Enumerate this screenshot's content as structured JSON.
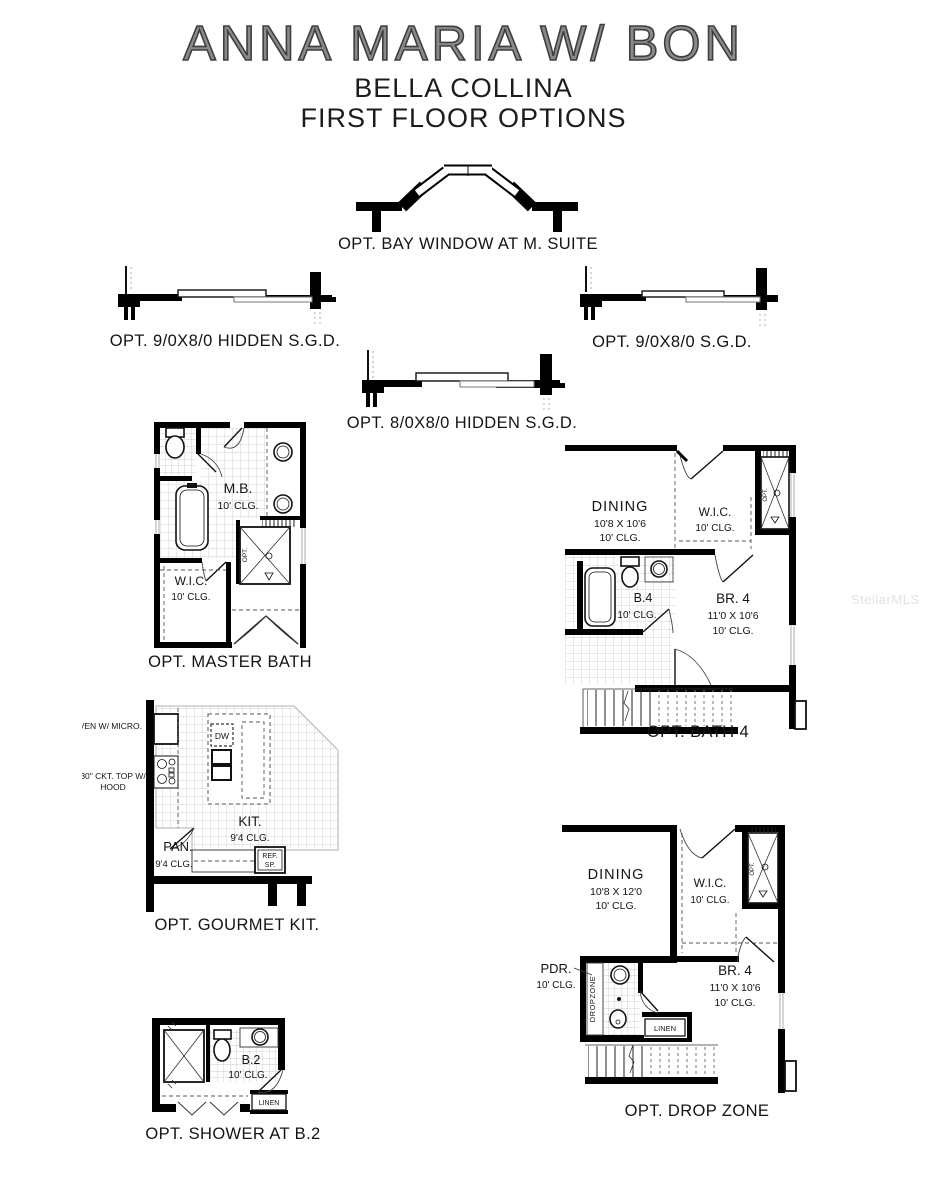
{
  "header": {
    "title": "ANNA MARIA W/ BON",
    "subtitle": "BELLA COLLINA",
    "subtitle2": "FIRST FLOOR OPTIONS"
  },
  "watermark": "StellarMLS",
  "captions": {
    "bay_window": "OPT. BAY WINDOW AT M. SUITE",
    "sgd_hidden_90": "OPT. 9/0X8/0 HIDDEN S.G.D.",
    "sgd_90": "OPT. 9/0X8/0 S.G.D.",
    "sgd_hidden_80": "OPT. 8/0X8/0 HIDDEN S.G.D.",
    "master_bath": "OPT. MASTER BATH",
    "bath4": "OPT. BATH 4",
    "gourmet_kit": "OPT. GOURMET KIT.",
    "drop_zone": "OPT. DROP ZONE",
    "shower_b2": "OPT. SHOWER AT B.2"
  },
  "master_bath": {
    "room": "M.B.",
    "room_clg": "10' CLG.",
    "wic": "W.I.C.",
    "wic_clg": "10' CLG.",
    "opt": "OPT."
  },
  "bath4": {
    "dining": "DINING",
    "dining_size": "10'8 X 10'6",
    "dining_clg": "10' CLG.",
    "wic": "W.I.C.",
    "wic_clg": "10' CLG.",
    "b4": "B.4",
    "b4_clg": "10' CLG.",
    "br4": "BR. 4",
    "br4_size": "11'0 X 10'6",
    "br4_clg": "10' CLG.",
    "opt": "OPT."
  },
  "kitchen": {
    "oven": "OVEN W/ MICRO.",
    "cooktop1": "30\" CKT. TOP W/",
    "cooktop2": "HOOD",
    "dw": "DW",
    "kit": "KIT.",
    "kit_clg": "9'4 CLG.",
    "pan": "PAN.",
    "pan_clg": "9'4 CLG.",
    "ref1": "REF.",
    "ref2": "SP."
  },
  "drop_zone": {
    "dining": "DINING",
    "dining_size": "10'8 X 12'0",
    "dining_clg": "10' CLG.",
    "wic": "W.I.C.",
    "wic_clg": "10' CLG.",
    "pdr": "PDR.",
    "pdr_clg": "10' CLG.",
    "dropzone": "DROPZONE",
    "linen": "LINEN",
    "br4": "BR. 4",
    "br4_size": "11'0 X 10'6",
    "br4_clg": "10' CLG.",
    "opt": "OPT."
  },
  "shower_b2": {
    "b2": "B.2",
    "b2_clg": "10' CLG.",
    "linen": "LINEN"
  }
}
